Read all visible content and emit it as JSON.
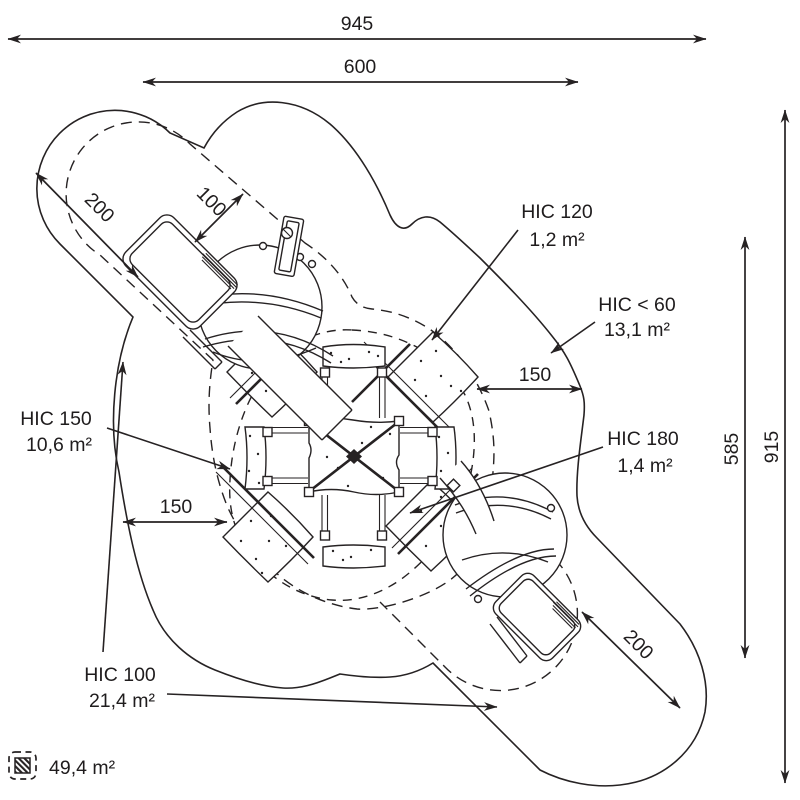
{
  "drawing": {
    "dimensions": {
      "overall_width": "945",
      "equipment_width": "600",
      "fall_zone_top_left": "200",
      "clearance_top_left": "100",
      "clearance_left": "150",
      "clearance_right": "150",
      "fall_zone_bottom_right": "200",
      "equipment_height": "585",
      "overall_height": "915"
    },
    "hic_zones": [
      {
        "label": "HIC 120",
        "area": "1,2 m²"
      },
      {
        "label": "HIC < 60",
        "area": "13,1 m²"
      },
      {
        "label": "HIC 180",
        "area": "1,4 m²"
      },
      {
        "label": "HIC 150",
        "area": "10,6 m²"
      },
      {
        "label": "HIC 100",
        "area": "21,4 m²"
      }
    ],
    "legend": {
      "total_surface_area": "49,4 m²"
    },
    "colors": {
      "line": "#262223",
      "background": "#ffffff"
    }
  }
}
